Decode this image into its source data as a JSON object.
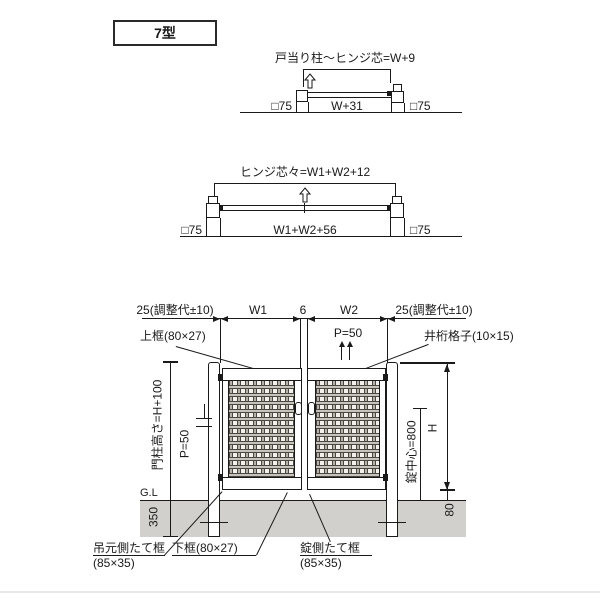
{
  "title": "7型",
  "plan_single": {
    "label": "戸当り柱～ヒンジ芯=W+9",
    "post_left": "□75",
    "width_label": "W+31",
    "post_right": "□75"
  },
  "plan_double": {
    "label": "ヒンジ芯々=W1+W2+12",
    "post_left": "□75",
    "width_label": "W1+W2+56",
    "post_right": "□75"
  },
  "elevation": {
    "adj_left": "25(調整代±10)",
    "w1": "W1",
    "gap": "6",
    "w2": "W2",
    "adj_right": "25(調整代±10)",
    "top_rail": "上框(80×27)",
    "pitch_top": "P=50",
    "grid": "井桁格子(10×15)",
    "post_height": "門柱高さ=H+100",
    "pitch_left": "P=50",
    "gl": "G.L",
    "embed": "350",
    "lock_center": "錠中心=800",
    "height": "H",
    "bottom_gap": "80",
    "hinge_stile": "吊元側たて框",
    "hinge_stile_size": "(85×35)",
    "bottom_rail": "下框(80×27)",
    "lock_stile": "錠側たて框",
    "lock_stile_size": "(85×35)"
  },
  "icons": {
    "swing_arrow": "hollow-up-arrow"
  },
  "colors": {
    "line": "#1a1a1a",
    "ground": "#d2d0cd",
    "mesh_light": "#f3f1ee",
    "mesh_dark": "#4a4642"
  }
}
